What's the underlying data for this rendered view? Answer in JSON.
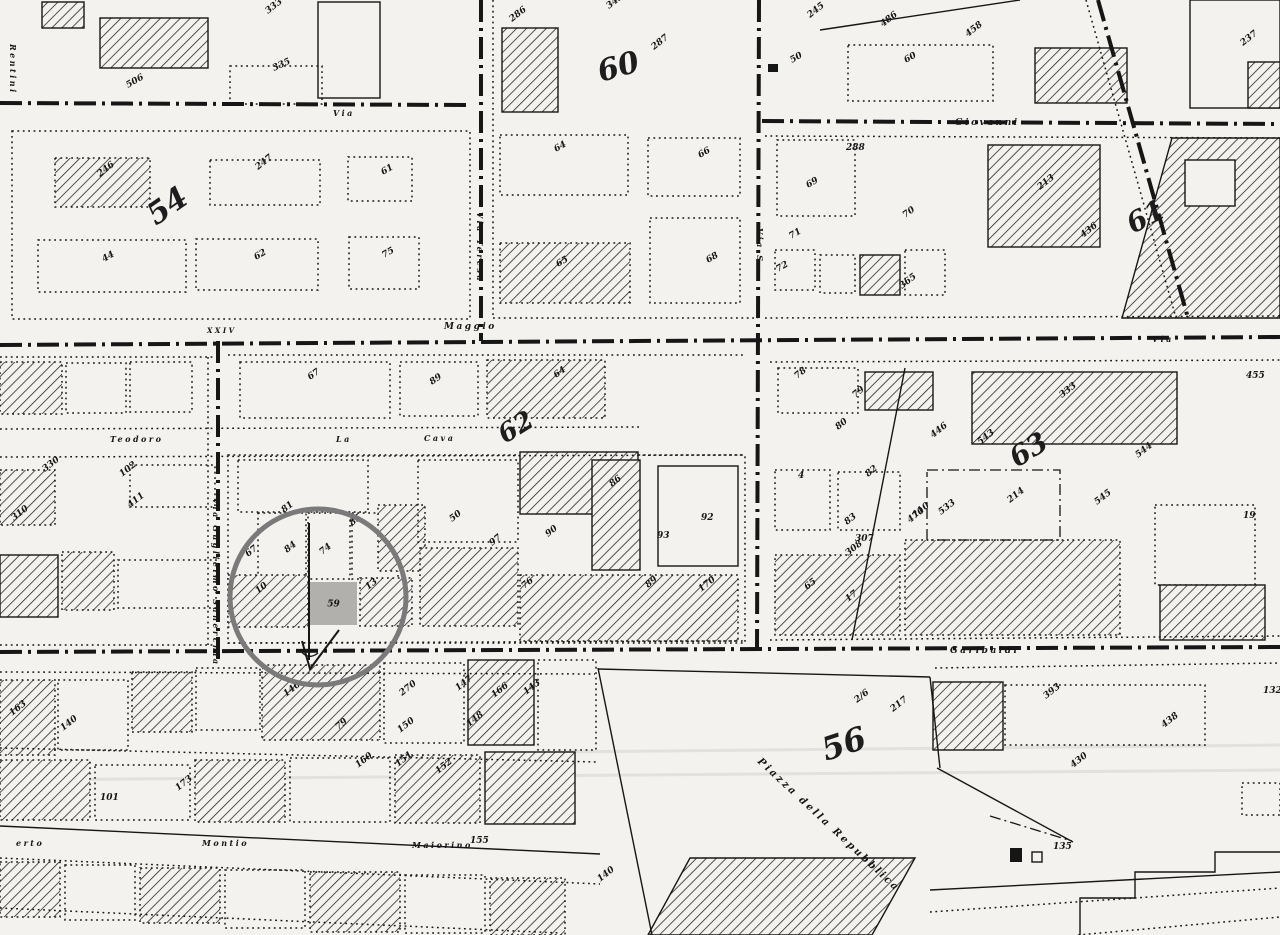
{
  "palette": {
    "paper": "#f3f2ef",
    "ink": "#161616",
    "faded_ink": "#1d1d1d",
    "annotation_circle": "#7a7a7a",
    "parcel_highlight": "#b1b0ad",
    "scan_artifact": "rgba(20,20,20,0.08)"
  },
  "annotation": {
    "circle": {
      "cx": 318,
      "cy": 597,
      "r": 88,
      "stroke_width": 5
    },
    "highlight": {
      "x": 310,
      "y": 582,
      "w": 47,
      "h": 43,
      "label": "59"
    },
    "mark": "surveyor-check-mark"
  },
  "district_numbers": [
    {
      "t": "54",
      "x": 156,
      "y": 226,
      "r": -35,
      "size": 30
    },
    {
      "t": "60",
      "x": 601,
      "y": 82,
      "r": -16,
      "size": 30
    },
    {
      "t": "61",
      "x": 1133,
      "y": 234,
      "r": -28,
      "size": 28
    },
    {
      "t": "62",
      "x": 505,
      "y": 444,
      "r": -32,
      "size": 26
    },
    {
      "t": "63",
      "x": 1017,
      "y": 468,
      "r": -32,
      "size": 28
    },
    {
      "t": "56",
      "x": 826,
      "y": 761,
      "r": -18,
      "size": 32
    }
  ],
  "street_labels": [
    {
      "t": "Rentini",
      "x": 10,
      "y": 44,
      "r": 90,
      "size": 8
    },
    {
      "t": "Via",
      "x": 333,
      "y": 116,
      "r": 0,
      "size": 8
    },
    {
      "t": "Giovanni",
      "x": 955,
      "y": 125,
      "r": 0,
      "size": 9
    },
    {
      "t": "Via Teresa",
      "x": 477,
      "y": 212,
      "r": 90,
      "size": 8
    },
    {
      "t": "Via S.",
      "x": 757,
      "y": 228,
      "r": 90,
      "size": 8
    },
    {
      "t": "XXIV",
      "x": 207,
      "y": 333,
      "r": 0,
      "size": 7
    },
    {
      "t": "Maggio",
      "x": 444,
      "y": 329,
      "r": 0,
      "size": 9
    },
    {
      "t": "Via",
      "x": 1152,
      "y": 342,
      "r": 0,
      "size": 8
    },
    {
      "t": "Teodoro",
      "x": 110,
      "y": 442,
      "r": 0,
      "size": 8
    },
    {
      "t": "La",
      "x": 336,
      "y": 442,
      "r": 0,
      "size": 8
    },
    {
      "t": "Cava",
      "x": 424,
      "y": 441,
      "r": 0,
      "size": 8
    },
    {
      "t": "Via Guglielmo Sanerchia",
      "x": 213,
      "y": 498,
      "r": 90,
      "size": 8
    },
    {
      "t": "Garibaldi",
      "x": 950,
      "y": 653,
      "r": 0,
      "size": 9
    },
    {
      "t": "Piazza della Repubblica",
      "x": 757,
      "y": 762,
      "r": 43,
      "size": 10
    },
    {
      "t": "erto",
      "x": 16,
      "y": 846,
      "r": 0,
      "size": 8
    },
    {
      "t": "Montio",
      "x": 202,
      "y": 846,
      "r": 0,
      "size": 8
    },
    {
      "t": "Maiorino",
      "x": 412,
      "y": 848,
      "r": 0,
      "size": 8
    }
  ],
  "parcel_numbers": [
    {
      "t": "333",
      "x": 268,
      "y": 14
    },
    {
      "t": "506",
      "x": 128,
      "y": 88,
      "r": -30
    },
    {
      "t": "335",
      "x": 274,
      "y": 71,
      "r": -25
    },
    {
      "t": "286",
      "x": 512,
      "y": 22
    },
    {
      "t": "343",
      "x": 609,
      "y": 9
    },
    {
      "t": "287",
      "x": 654,
      "y": 50
    },
    {
      "t": "245",
      "x": 810,
      "y": 18
    },
    {
      "t": "486",
      "x": 883,
      "y": 27
    },
    {
      "t": "458",
      "x": 968,
      "y": 37
    },
    {
      "t": "50",
      "x": 792,
      "y": 63,
      "r": -30
    },
    {
      "t": "60",
      "x": 906,
      "y": 63,
      "r": -30
    },
    {
      "t": "237",
      "x": 1243,
      "y": 46
    },
    {
      "t": "64",
      "x": 556,
      "y": 152,
      "r": -30
    },
    {
      "t": "66",
      "x": 700,
      "y": 158,
      "r": -30
    },
    {
      "t": "65",
      "x": 558,
      "y": 267,
      "r": -30
    },
    {
      "t": "68",
      "x": 708,
      "y": 263,
      "r": -30
    },
    {
      "t": "288",
      "x": 846,
      "y": 150,
      "r": 0
    },
    {
      "t": "69",
      "x": 808,
      "y": 188,
      "r": -30
    },
    {
      "t": "70",
      "x": 905,
      "y": 218,
      "r": -35
    },
    {
      "t": "213",
      "x": 1040,
      "y": 190
    },
    {
      "t": "71",
      "x": 791,
      "y": 239,
      "r": -30
    },
    {
      "t": "72",
      "x": 778,
      "y": 272,
      "r": -30
    },
    {
      "t": "365",
      "x": 902,
      "y": 289
    },
    {
      "t": "436",
      "x": 1083,
      "y": 238
    },
    {
      "t": "246",
      "x": 100,
      "y": 177
    },
    {
      "t": "247",
      "x": 258,
      "y": 170
    },
    {
      "t": "61",
      "x": 383,
      "y": 175,
      "r": -30
    },
    {
      "t": "44",
      "x": 104,
      "y": 262,
      "r": -30
    },
    {
      "t": "62",
      "x": 256,
      "y": 260,
      "r": -30
    },
    {
      "t": "75",
      "x": 384,
      "y": 258,
      "r": -30
    },
    {
      "t": "67",
      "x": 310,
      "y": 380,
      "r": -35
    },
    {
      "t": "89",
      "x": 432,
      "y": 385,
      "r": -35
    },
    {
      "t": "64",
      "x": 556,
      "y": 378,
      "r": -35
    },
    {
      "t": "330",
      "x": 45,
      "y": 472
    },
    {
      "t": "102",
      "x": 122,
      "y": 477
    },
    {
      "t": "411",
      "x": 130,
      "y": 508
    },
    {
      "t": "310",
      "x": 14,
      "y": 521
    },
    {
      "t": "81",
      "x": 284,
      "y": 513
    },
    {
      "t": "85",
      "x": 352,
      "y": 526
    },
    {
      "t": "84",
      "x": 287,
      "y": 553
    },
    {
      "t": "74",
      "x": 322,
      "y": 555
    },
    {
      "t": "67",
      "x": 248,
      "y": 557
    },
    {
      "t": "10",
      "x": 258,
      "y": 594
    },
    {
      "t": "13",
      "x": 368,
      "y": 590
    },
    {
      "t": "86",
      "x": 612,
      "y": 487
    },
    {
      "t": "50",
      "x": 452,
      "y": 522
    },
    {
      "t": "97",
      "x": 492,
      "y": 546
    },
    {
      "t": "90",
      "x": 548,
      "y": 537
    },
    {
      "t": "92",
      "x": 701,
      "y": 520,
      "r": 0
    },
    {
      "t": "93",
      "x": 657,
      "y": 538,
      "r": 0
    },
    {
      "t": "89",
      "x": 648,
      "y": 588
    },
    {
      "t": "170",
      "x": 701,
      "y": 592
    },
    {
      "t": "76",
      "x": 524,
      "y": 589
    },
    {
      "t": "78",
      "x": 797,
      "y": 379
    },
    {
      "t": "79",
      "x": 855,
      "y": 398
    },
    {
      "t": "80",
      "x": 838,
      "y": 430
    },
    {
      "t": "4",
      "x": 798,
      "y": 478,
      "r": 0
    },
    {
      "t": "82",
      "x": 868,
      "y": 477
    },
    {
      "t": "83",
      "x": 847,
      "y": 525
    },
    {
      "t": "446",
      "x": 933,
      "y": 438
    },
    {
      "t": "543",
      "x": 980,
      "y": 445
    },
    {
      "t": "333",
      "x": 1062,
      "y": 398
    },
    {
      "t": "544",
      "x": 1138,
      "y": 458
    },
    {
      "t": "545",
      "x": 1097,
      "y": 505
    },
    {
      "t": "214",
      "x": 1010,
      "y": 503
    },
    {
      "t": "533",
      "x": 941,
      "y": 515
    },
    {
      "t": "470",
      "x": 910,
      "y": 523
    },
    {
      "t": "455",
      "x": 1246,
      "y": 378,
      "r": 0
    },
    {
      "t": "19",
      "x": 1243,
      "y": 518,
      "r": 0
    },
    {
      "t": "307",
      "x": 855,
      "y": 541,
      "r": 0
    },
    {
      "t": "308",
      "x": 848,
      "y": 556
    },
    {
      "t": "65",
      "x": 807,
      "y": 590
    },
    {
      "t": "17",
      "x": 848,
      "y": 602
    },
    {
      "t": "110",
      "x": 915,
      "y": 518
    },
    {
      "t": "2/6",
      "x": 857,
      "y": 703
    },
    {
      "t": "217",
      "x": 893,
      "y": 712
    },
    {
      "t": "393",
      "x": 1046,
      "y": 699
    },
    {
      "t": "430",
      "x": 1073,
      "y": 768
    },
    {
      "t": "438",
      "x": 1164,
      "y": 728
    },
    {
      "t": "132",
      "x": 1263,
      "y": 693,
      "r": 0
    },
    {
      "t": "135",
      "x": 1053,
      "y": 849,
      "r": 0
    },
    {
      "t": "163",
      "x": 12,
      "y": 716
    },
    {
      "t": "140",
      "x": 63,
      "y": 731
    },
    {
      "t": "146",
      "x": 286,
      "y": 697
    },
    {
      "t": "270",
      "x": 402,
      "y": 696
    },
    {
      "t": "147",
      "x": 458,
      "y": 691
    },
    {
      "t": "166",
      "x": 494,
      "y": 698
    },
    {
      "t": "143",
      "x": 526,
      "y": 695
    },
    {
      "t": "79",
      "x": 338,
      "y": 730
    },
    {
      "t": "150",
      "x": 400,
      "y": 733
    },
    {
      "t": "148",
      "x": 469,
      "y": 727
    },
    {
      "t": "160",
      "x": 358,
      "y": 768
    },
    {
      "t": "151",
      "x": 398,
      "y": 767
    },
    {
      "t": "152",
      "x": 438,
      "y": 774
    },
    {
      "t": "101",
      "x": 100,
      "y": 800,
      "r": 0
    },
    {
      "t": "173",
      "x": 178,
      "y": 791
    },
    {
      "t": "155",
      "x": 470,
      "y": 843,
      "r": 0
    },
    {
      "t": "140",
      "x": 600,
      "y": 882
    }
  ]
}
